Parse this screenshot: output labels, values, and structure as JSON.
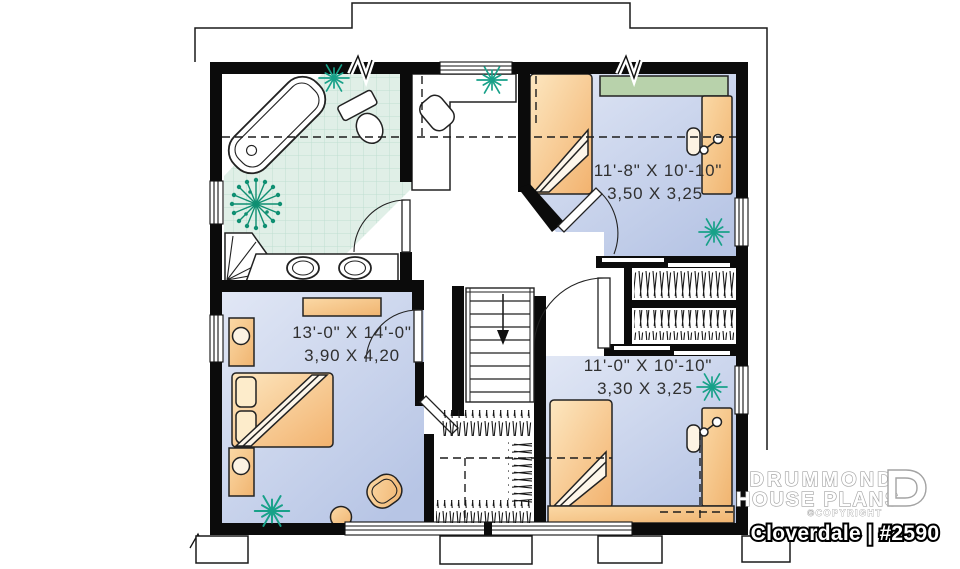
{
  "floorplan": {
    "rooms": [
      {
        "id": "master-bedroom",
        "size_imperial": "13'-0\" X 14'-0\"",
        "size_metric": "3,90 X 4,20"
      },
      {
        "id": "bedroom-upper-right",
        "size_imperial": "11'-8\" X 10'-10\"",
        "size_metric": "3,50 X 3,25"
      },
      {
        "id": "bedroom-lower-right",
        "size_imperial": "11'-0\" X 10'-10\"",
        "size_metric": "3,30 X 3,25"
      }
    ]
  },
  "branding": {
    "name_line1": "DRUMMOND",
    "name_line2": "HOUSE PLANS",
    "copyright": "©COPYRIGHT",
    "plan_label": "Cloverdale | #2590"
  },
  "colors": {
    "wall": "#0b0b0b",
    "floor_light": "#e1e7f5",
    "floor_dark": "#b7c5e5",
    "furniture_light": "#fde7c0",
    "furniture_dark": "#f2b26e",
    "tile": "#e0efe7",
    "tile_grid": "#bfdfd2",
    "plant": "#18a189",
    "shelf_green": "#b8d2ab",
    "label_text": "#303030"
  }
}
